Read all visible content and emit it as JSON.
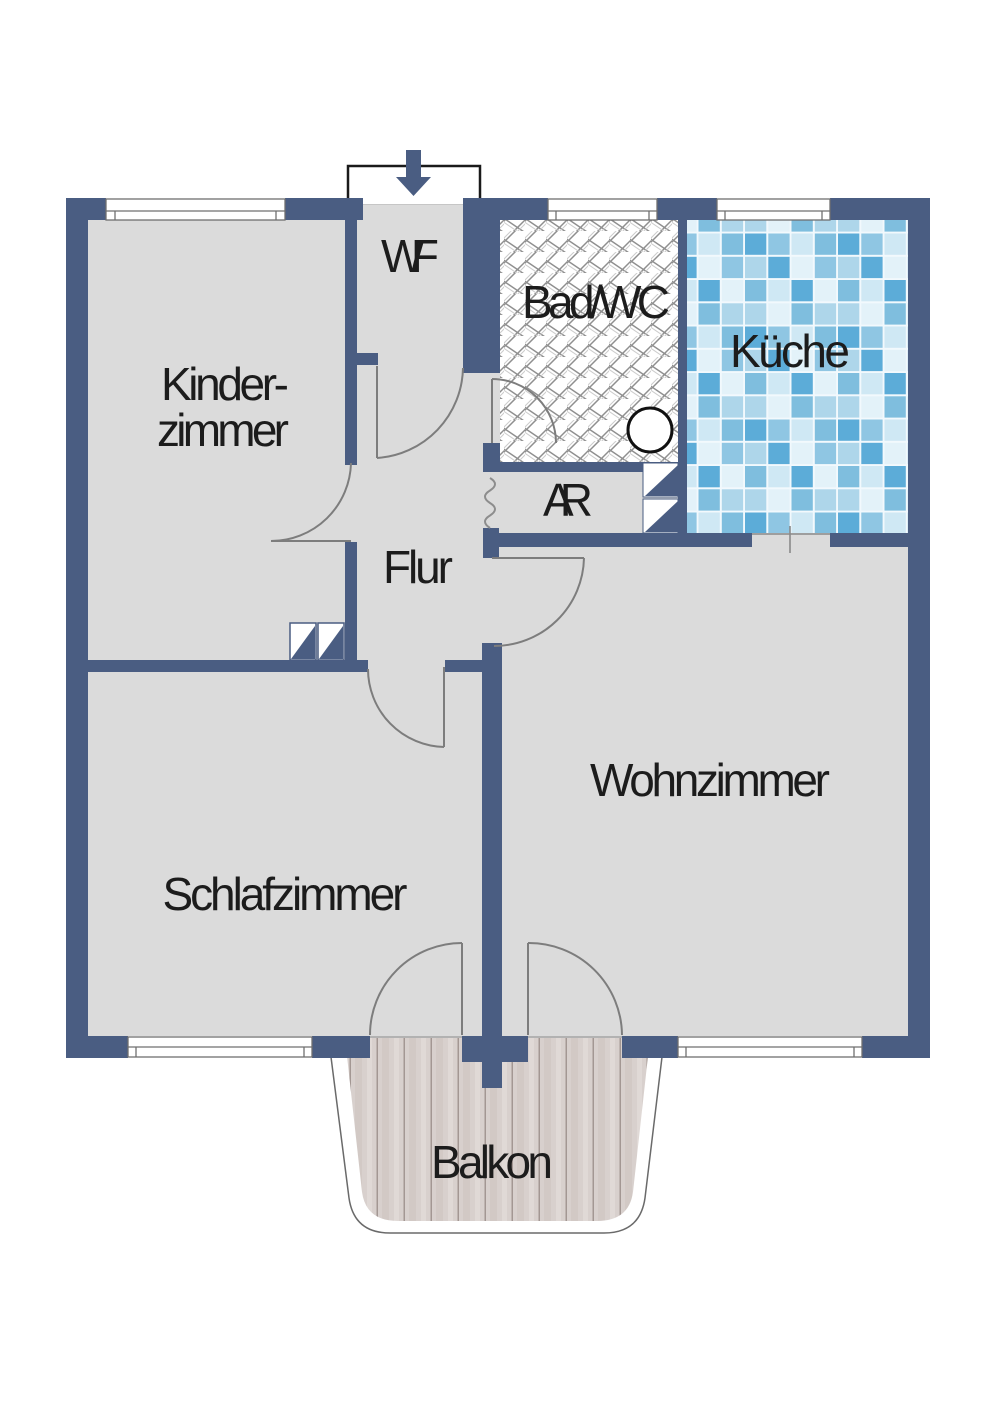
{
  "rooms": {
    "kinderzimmer": {
      "line1": "Kinder-",
      "line2": "zimmer"
    },
    "wf": {
      "label": "WF"
    },
    "bad_wc": {
      "label": "Bad/WC"
    },
    "kueche": {
      "label": "Küche"
    },
    "ar": {
      "label": "AR"
    },
    "flur": {
      "label": "Flur"
    },
    "wohnzimmer": {
      "label": "Wohnzimmer"
    },
    "schlafzimmer": {
      "label": "Schlafzimmer"
    },
    "balkon": {
      "label": "Balkon"
    }
  },
  "symbols": {
    "entrance_arrow": "down-arrow-entrance",
    "sink": "round-washbasin",
    "radiator": "squiggle-pipe",
    "wardrobe": "built-in-closet",
    "shelves": "storage-shelf-triangles"
  },
  "colors": {
    "wall": "#4a5d82",
    "floor": "#dbdbdb",
    "door_line": "#7d7d7d",
    "window_line": "#6f6f6f",
    "outline_dark": "#1a1a1a",
    "hatch_line": "#8f8f8f",
    "tile_dark": "#5cacd8",
    "tile_mid": "#8fc6e3",
    "tile_light": "#cfe8f4",
    "wood": "#d8d0cd",
    "wood_line": "#a39793",
    "text": "#1c1c1c"
  }
}
